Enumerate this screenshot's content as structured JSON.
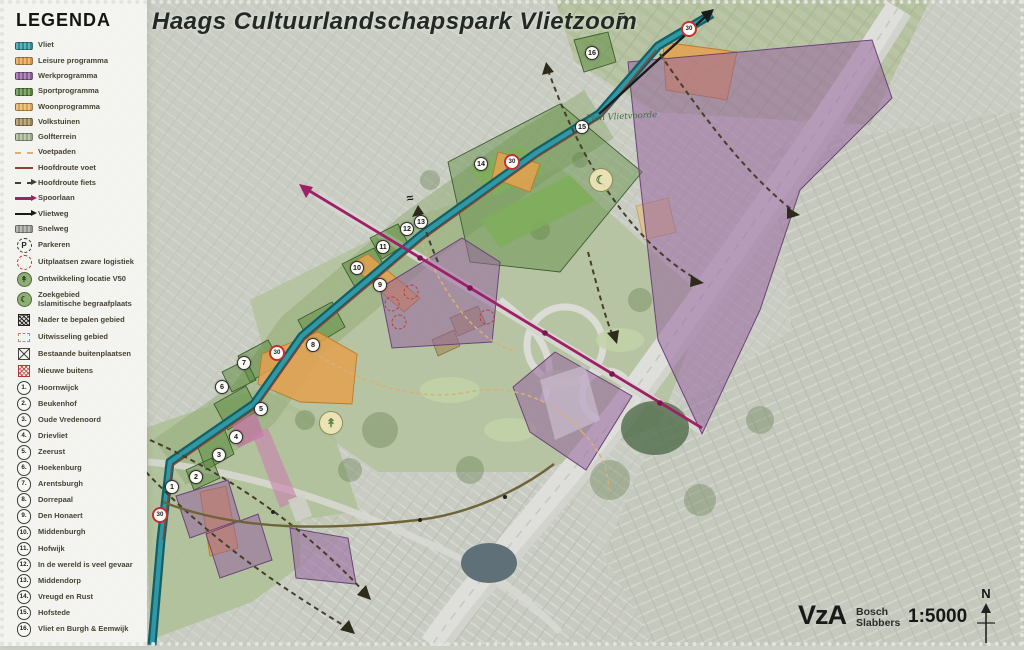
{
  "title": "Haags Cultuurlandschapspark Vlietzoom",
  "legend": {
    "heading": "LEGENDA",
    "items": [
      {
        "icon": "sw sw-vliet",
        "icon_name": "vliet-swatch",
        "label": "Vliet"
      },
      {
        "icon": "sw sw-leisure",
        "icon_name": "leisure-swatch",
        "label": "Leisure programma"
      },
      {
        "icon": "sw sw-werk",
        "icon_name": "werkprogramma-swatch",
        "label": "Werkprogramma"
      },
      {
        "icon": "sw sw-sport",
        "icon_name": "sportprogramma-swatch",
        "label": "Sportprogramma"
      },
      {
        "icon": "sw sw-woon",
        "icon_name": "woonprogramma-swatch",
        "label": "Woonprogramma"
      },
      {
        "icon": "sw sw-volks",
        "icon_name": "volkstuinen-swatch",
        "label": "Volkstuinen"
      },
      {
        "icon": "sw sw-golf",
        "icon_name": "golfterrein-swatch",
        "label": "Golfterrein"
      },
      {
        "icon": "ln ln-voetpad",
        "icon_name": "voetpaden-line-icon",
        "label": "Voetpaden"
      },
      {
        "icon": "ln ln-voet",
        "icon_name": "hoofdroute-voet-line-icon",
        "label": "Hoofdroute voet"
      },
      {
        "icon": "ln ln-fiets arrow-end",
        "icon_name": "hoofdroute-fiets-arrow-icon",
        "label": "Hoofdroute fiets"
      },
      {
        "icon": "ln ln-spoor arrow-end",
        "icon_name": "spoorlaan-arrow-icon",
        "label": "Spoorlaan"
      },
      {
        "icon": "ln ln-vlietweg arrow-end",
        "icon_name": "vlietweg-arrow-icon",
        "label": "Vlietweg"
      },
      {
        "icon": "sw sw-snelweg",
        "icon_name": "snelweg-swatch",
        "label": "Snelweg"
      },
      {
        "icon": "circ ic-parkeren",
        "icon_name": "parkeren-icon",
        "glyph": "P",
        "label": "Parkeren",
        "row": "icn"
      },
      {
        "icon": "circ ic-logistiek",
        "icon_name": "zware-logistiek-icon",
        "label": "Uitplaatsen zware logistiek",
        "row": "icn"
      },
      {
        "icon": "circ ic-v50",
        "icon_name": "locatie-v50-icon",
        "glyph": "↟",
        "label": "Ontwikkeling locatie V50",
        "row": "icn"
      },
      {
        "icon": "circ ic-begraaf",
        "icon_name": "islamitische-begraafplaats-icon",
        "glyph": "☾",
        "label": "Zoekgebied",
        "label2": "Islamitische begraafplaats",
        "row": "icn"
      },
      {
        "icon": "sq ic-nader",
        "icon_name": "nader-te-bepalen-icon",
        "label": "Nader te bepalen gebied",
        "row": "icn"
      },
      {
        "icon": "sq ic-uitwissel",
        "icon_name": "uitwisseling-gebied-icon",
        "label": "Uitwisseling gebied",
        "row": "icn"
      },
      {
        "icon": "sq ic-bestaand",
        "icon_name": "bestaande-buitenplaatsen-icon",
        "label": "Bestaande buitenplaatsen",
        "row": "icn"
      },
      {
        "icon": "sq ic-nieuw",
        "icon_name": "nieuwe-buitens-icon",
        "label": "Nieuwe buitens",
        "row": "icn"
      }
    ],
    "numbered": [
      {
        "num": "1.",
        "label": "Hoornwijck"
      },
      {
        "num": "2.",
        "label": "Beukenhof"
      },
      {
        "num": "3.",
        "label": "Oude Vredenoord"
      },
      {
        "num": "4.",
        "label": "Drievliet"
      },
      {
        "num": "5.",
        "label": "Zeerust"
      },
      {
        "num": "6.",
        "label": "Hoekenburg"
      },
      {
        "num": "7.",
        "label": "Arentsburgh"
      },
      {
        "num": "8.",
        "label": "Dorrepaal"
      },
      {
        "num": "9.",
        "label": "Den Honaert"
      },
      {
        "num": "10.",
        "label": "Middenburgh"
      },
      {
        "num": "11.",
        "label": "Hofwijk"
      },
      {
        "num": "12.",
        "label": "In de wereld is veel gevaar"
      },
      {
        "num": "13.",
        "label": "Middendorp"
      },
      {
        "num": "14.",
        "label": "Vreugd en Rust"
      },
      {
        "num": "15.",
        "label": "Hofstede"
      },
      {
        "num": "16.",
        "label": "Vliet en Burgh & Eemwijk"
      }
    ]
  },
  "map": {
    "script_label": "Plan Vlietvoorde",
    "markers": [
      {
        "n": "1",
        "x": 172,
        "y": 487
      },
      {
        "n": "2",
        "x": 196,
        "y": 477
      },
      {
        "n": "3",
        "x": 219,
        "y": 455
      },
      {
        "n": "4",
        "x": 236,
        "y": 437
      },
      {
        "n": "5",
        "x": 261,
        "y": 409
      },
      {
        "n": "6",
        "x": 222,
        "y": 387
      },
      {
        "n": "7",
        "x": 244,
        "y": 363
      },
      {
        "n": "8",
        "x": 313,
        "y": 345
      },
      {
        "n": "9",
        "x": 380,
        "y": 285
      },
      {
        "n": "10",
        "x": 357,
        "y": 268
      },
      {
        "n": "11",
        "x": 383,
        "y": 247
      },
      {
        "n": "12",
        "x": 407,
        "y": 229
      },
      {
        "n": "13",
        "x": 421,
        "y": 222
      },
      {
        "n": "14",
        "x": 481,
        "y": 164
      },
      {
        "n": "15",
        "x": 582,
        "y": 127
      },
      {
        "n": "16",
        "x": 592,
        "y": 53
      }
    ],
    "speed_signs": [
      {
        "label": "30",
        "x": 160,
        "y": 515
      },
      {
        "label": "30",
        "x": 277,
        "y": 353
      },
      {
        "label": "30",
        "x": 512,
        "y": 162
      },
      {
        "label": "30",
        "x": 689,
        "y": 29
      }
    ],
    "icon_markers": [
      {
        "type": "v50",
        "name": "locatie-v50-map-icon",
        "glyph": "↟",
        "x": 331,
        "y": 423
      },
      {
        "type": "begraaf",
        "name": "islamitische-begraafplaats-map-icon",
        "glyph": "☾",
        "x": 601,
        "y": 180
      },
      {
        "type": "squiggle",
        "name": "bridge-squiggle-icon",
        "glyph": "≈",
        "x": 410,
        "y": 198
      },
      {
        "type": "squiggle",
        "name": "bridge-squiggle-icon",
        "glyph": "≈",
        "x": 622,
        "y": 15
      }
    ],
    "logistics_circles": [
      {
        "x": 392,
        "y": 304
      },
      {
        "x": 399,
        "y": 322
      },
      {
        "x": 411,
        "y": 292
      },
      {
        "x": 487,
        "y": 317
      }
    ]
  },
  "footer": {
    "client": "VzA",
    "firm_line1": "Bosch",
    "firm_line2": "Slabbers",
    "scale": "1:5000",
    "north_label": "N"
  },
  "colors": {
    "vliet": "#2f98a3",
    "leisure_orange": "#e5a14f",
    "werk_purple": "#95649f",
    "sport_green": "#5e8c42",
    "woon_orange": "#e8b25c",
    "volkstuinen": "#a5905a",
    "golf_green": "#a9b694",
    "voetpad_tan": "#d7b176",
    "hoofdroute_voet_red": "#93402f",
    "hoofdroute_fiets_dark": "#453e2a",
    "spoorlaan_magenta": "#9e2066",
    "vlietweg_black": "#1a1a1a",
    "snelweg_gray": "#a2a29c",
    "logistiek_red": "#c0392b",
    "speed_sign_red": "#c53030"
  }
}
